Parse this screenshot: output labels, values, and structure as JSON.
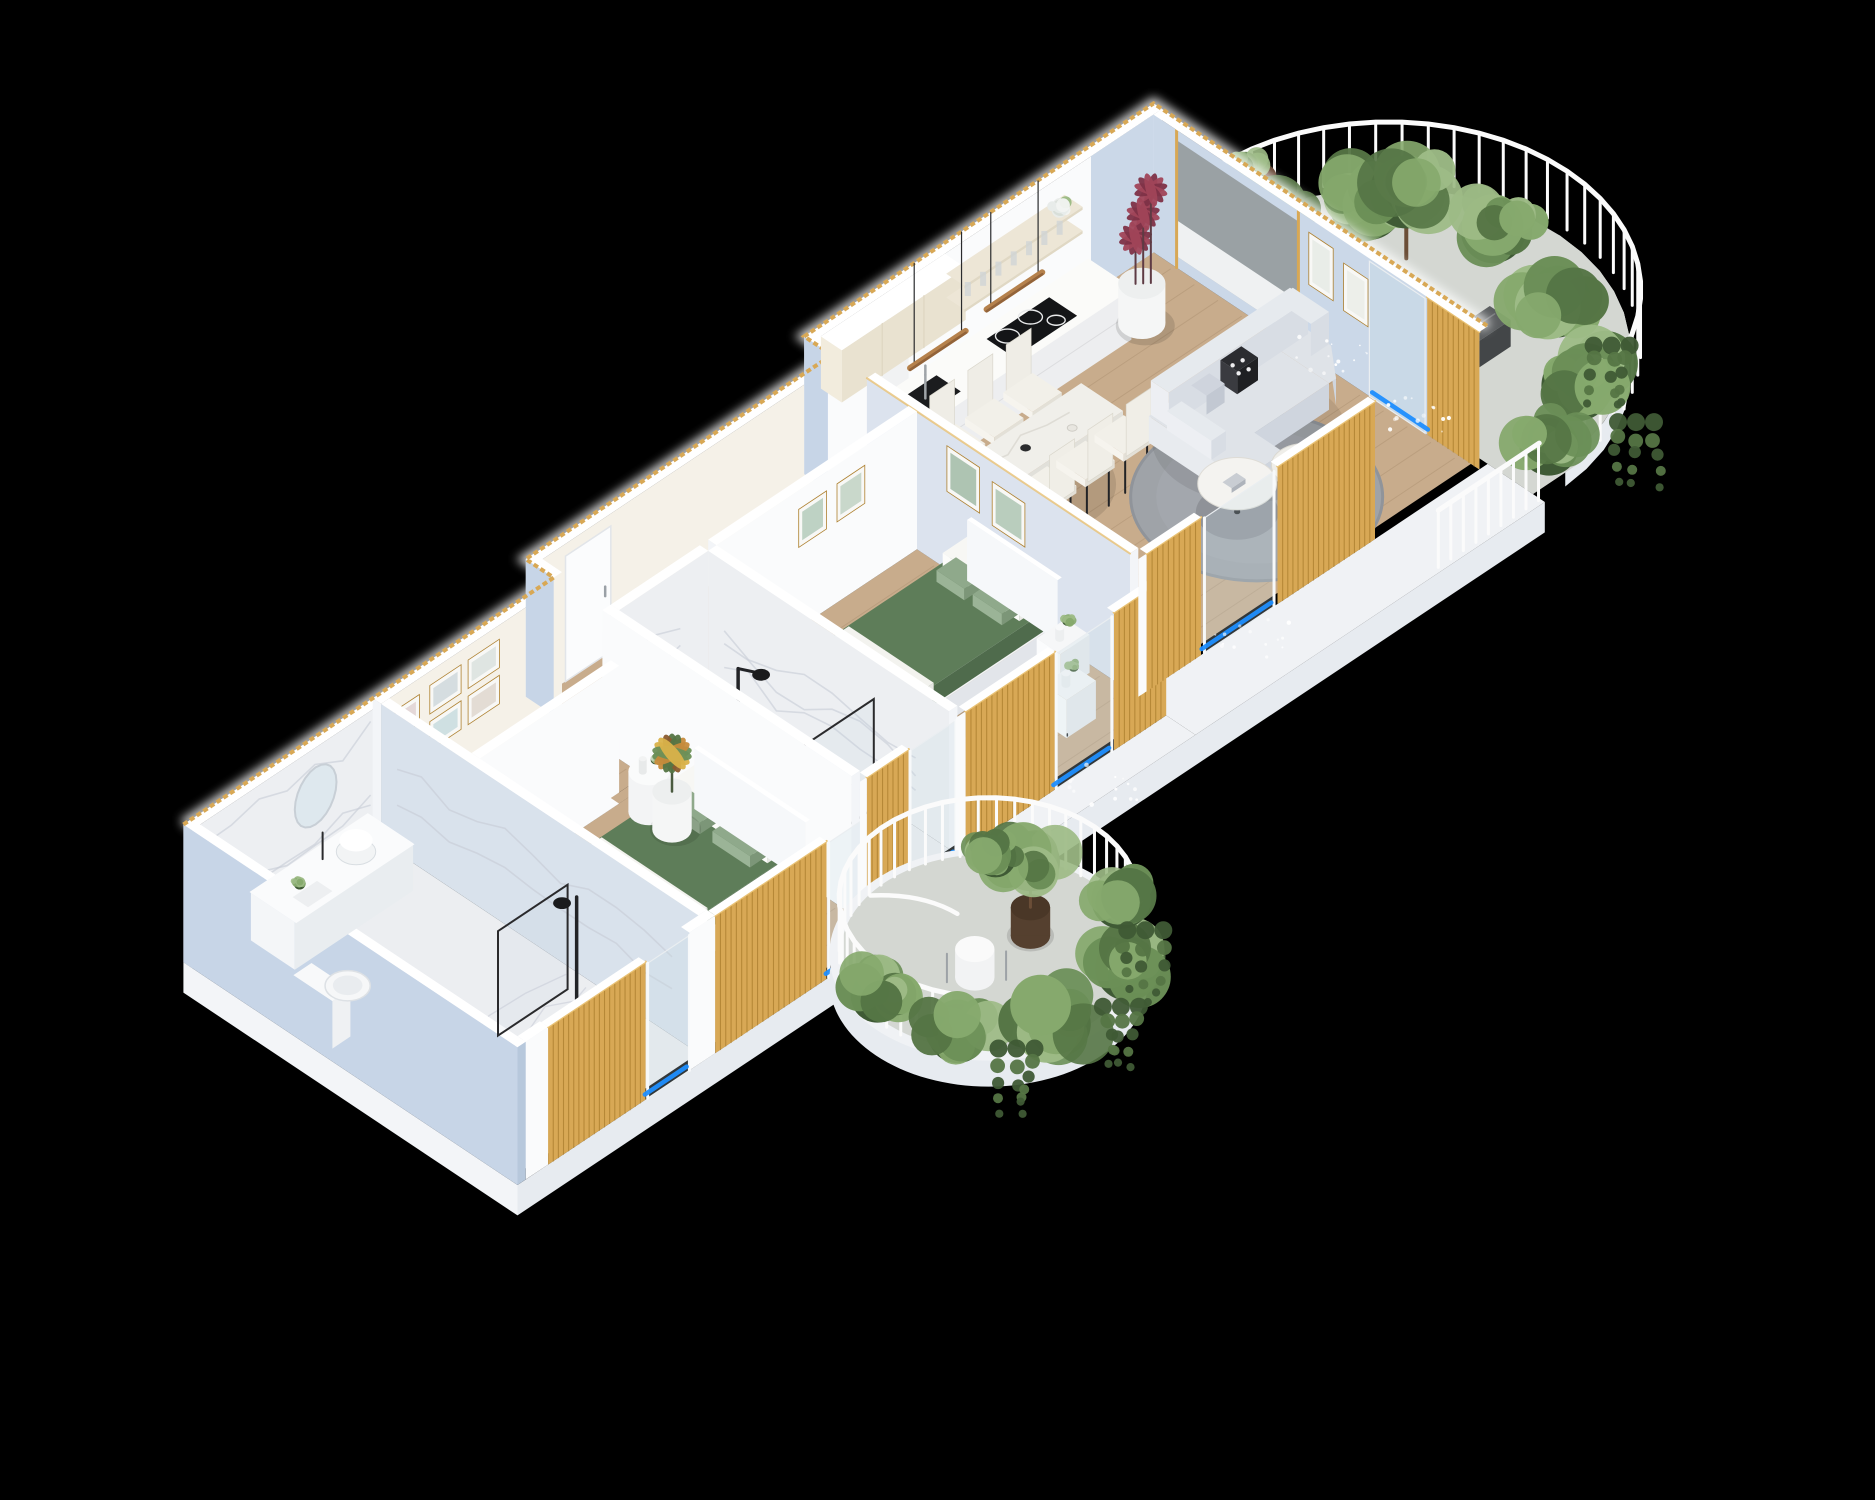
{
  "meta": {
    "kind": "isometric-3d-apartment-floorplan-render",
    "background": "#000000"
  },
  "palette": {
    "bg": "#000000",
    "slab": "#F0F2F5",
    "slabFascia": "#E7EBF0",
    "slabSide": "#F3F5F8",
    "wallTop": "#FFFFFF",
    "wallWhite": "#FAFBFC",
    "wallWarm": "#F5F1E8",
    "wallShade": "#E8ECF2",
    "wallBlue": "#C7D5E7",
    "wallBlueDeep": "#B7C8DC",
    "wallPanelBlue": "#CBD8E8",
    "wallArtBlue": "#DCE3EE",
    "floorWood": "#C8AC8C",
    "floorWoodLine": "#A98D6D",
    "floorMarble": "#ECEEF1",
    "marbleWall": "#EDEFF2",
    "marbleVein": "#C6CBD6",
    "concrete": "#D4D7D2",
    "concreteLight": "#DEE1DC",
    "gold": "#D8A855",
    "goldLight": "#E9C275",
    "goldDark": "#AE8130",
    "glass": "#C8DAE4",
    "glassGray": "#9AA1A4",
    "accentBlue": "#1F8FFF",
    "greenDuvet": "#5E7D59",
    "greenDuvetDark": "#4F6B4C",
    "sage": "#8FA98B",
    "pillow": "#F4F4F1",
    "sofa": "#DFE3E8",
    "sofaDark": "#CFD5DE",
    "sofaBase": "#EBEEF2",
    "rug": "#9FA3A8",
    "rugEdge": "#90949A",
    "tableWhite": "#F0EFEA",
    "tableSide": "#E1E0DA",
    "chairSeat": "#F2F0E9",
    "black": "#222326",
    "woodBar": "#B5814C",
    "trunk": "#6B4E37",
    "plantG1": "#6B8F57",
    "plantG2": "#557545",
    "plantG3": "#86A96D",
    "plantG4": "#9DBB86",
    "plantDark": "#3F5A35",
    "plantRed": "#A04458",
    "plantRedDark": "#7E3247",
    "plantOrange": "#C68B3B",
    "plantYellow": "#D9B24A",
    "potWhite": "#F5F6F6",
    "potDark": "#55402F",
    "potBrown": "#6E4630",
    "cylBlue": "#C9DCE4",
    "cylBlueTop": "#D9E8EE",
    "mirror": "#DEE8EE",
    "bench": "#F2F3F4",
    "railWhite": "#FBFBFB"
  },
  "scene": {
    "rooms": {
      "bathroom": {
        "label": "bathroom with marble walls, vanity, round mirror, toilet and black shower"
      },
      "hallway": {
        "label": "entry hallway with framed artwork and white door"
      },
      "masterBedroom": {
        "label": "master bedroom with green double bed, bench and corner plant"
      },
      "showerRoom": {
        "label": "marble shower room with black fixture and glass screen"
      },
      "bedroom": {
        "label": "second bedroom with green bed, nightstands and wall art"
      },
      "kitchen": {
        "label": "kitchen with cream cabinets, black hob, sink and shelves"
      },
      "diningArea": {
        "label": "dining area with marble table and six chairs"
      },
      "livingRoom": {
        "label": "living room with gray L-sofa, round rug and coffee tables"
      },
      "terraceGarden": {
        "label": "curved terrace garden with white railing and dense planting"
      },
      "roundBalcony": {
        "label": "round balcony with white railing, bistro set and plants"
      },
      "walkway": {
        "label": "white walkway ledge with railing posts"
      }
    },
    "door_markers": {
      "color": "#1F8FFF",
      "count": 6
    },
    "materials": {
      "facade_screens": "gold vertical louvers",
      "roof_edge": "gold slat trim",
      "cut_walls": "glowing white tops"
    }
  }
}
